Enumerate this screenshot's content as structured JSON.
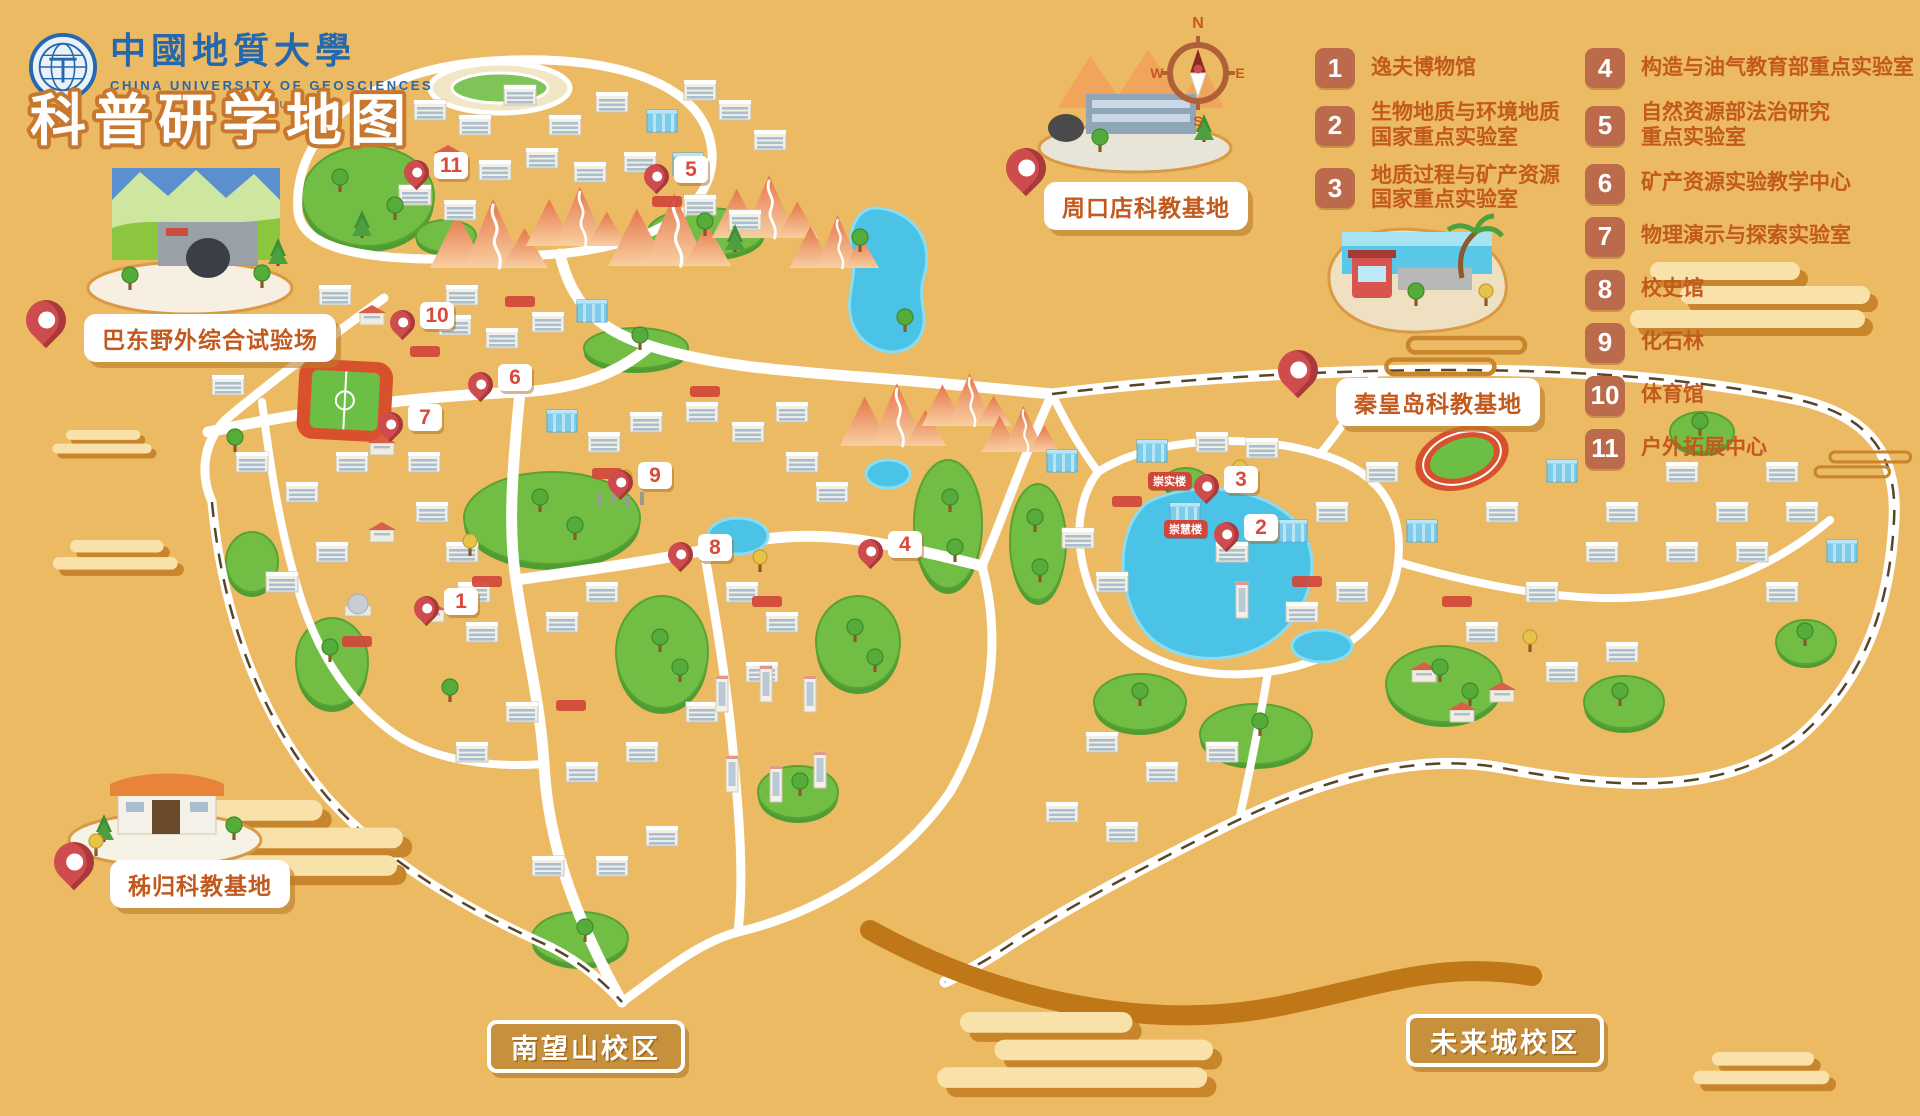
{
  "logo": {
    "name_zh": "中國地質大學",
    "name_en": "CHINA UNIVERSITY OF GEOSCIENCES",
    "subtitle": "武汉 · WUHAN"
  },
  "title": "科普研学地图",
  "compass": {
    "n": "N",
    "e": "E",
    "s": "S",
    "w": "W"
  },
  "legend": {
    "column1": [
      {
        "num": "1",
        "label": "逸夫博物馆"
      },
      {
        "num": "2",
        "label": "生物地质与环境地质\n国家重点实验室"
      },
      {
        "num": "3",
        "label": "地质过程与矿产资源\n国家重点实验室"
      }
    ],
    "column2": [
      {
        "num": "4",
        "label": "构造与油气教育部重点实验室"
      },
      {
        "num": "5",
        "label": "自然资源部法治研究\n重点实验室"
      },
      {
        "num": "6",
        "label": "矿产资源实验教学中心"
      },
      {
        "num": "7",
        "label": "物理演示与探索实验室"
      },
      {
        "num": "8",
        "label": "校史馆"
      },
      {
        "num": "9",
        "label": "化石林"
      },
      {
        "num": "10",
        "label": "体育馆"
      },
      {
        "num": "11",
        "label": "户外拓展中心"
      }
    ]
  },
  "bases": [
    {
      "id": "zhoukoudian",
      "label": "周口店科教基地",
      "pin": {
        "x": 1006,
        "y": 148
      },
      "box": {
        "x": 1044,
        "y": 182
      }
    },
    {
      "id": "badong",
      "label": "巴东野外综合试验场",
      "pin": {
        "x": 26,
        "y": 300
      },
      "box": {
        "x": 84,
        "y": 314
      }
    },
    {
      "id": "qinhuangdao",
      "label": "秦皇岛科教基地",
      "pin": {
        "x": 1278,
        "y": 350
      },
      "box": {
        "x": 1336,
        "y": 378
      }
    },
    {
      "id": "zigui",
      "label": "秭归科教基地",
      "pin": {
        "x": 54,
        "y": 842
      },
      "box": {
        "x": 110,
        "y": 860
      }
    }
  ],
  "campuses": [
    {
      "id": "nanwangshan",
      "label": "南望山校区",
      "box": {
        "x": 487,
        "y": 1020
      }
    },
    {
      "id": "weilaicheng",
      "label": "未来城校区",
      "box": {
        "x": 1406,
        "y": 1014
      }
    }
  ],
  "map_markers": [
    {
      "num": "11",
      "x": 404,
      "y": 152
    },
    {
      "num": "5",
      "x": 644,
      "y": 156
    },
    {
      "num": "10",
      "x": 390,
      "y": 302
    },
    {
      "num": "6",
      "x": 468,
      "y": 364
    },
    {
      "num": "7",
      "x": 378,
      "y": 404
    },
    {
      "num": "9",
      "x": 608,
      "y": 462
    },
    {
      "num": "8",
      "x": 668,
      "y": 534
    },
    {
      "num": "4",
      "x": 858,
      "y": 531
    },
    {
      "num": "1",
      "x": 414,
      "y": 588
    },
    {
      "num": "3",
      "x": 1194,
      "y": 466
    },
    {
      "num": "2",
      "x": 1214,
      "y": 514
    }
  ],
  "building_tags": [
    {
      "label": "崇实楼",
      "x": 1148,
      "y": 472
    },
    {
      "label": "崇慧楼",
      "x": 1164,
      "y": 520
    }
  ],
  "colors": {
    "background": "#ECBA63",
    "pin_red": "#CE4B4E",
    "legend_number_bg": "#BC6A4C",
    "legend_text": "#C2591D",
    "road": "#FFFFFF",
    "green": "#72BE45",
    "water": "#4BC3E6",
    "mountain": "#EE9A60",
    "cloud": "#F9E2A9",
    "cloud_shadow": "#C8852C",
    "campus_box": "#C58D3A",
    "logo_blue": "#2668AD"
  }
}
